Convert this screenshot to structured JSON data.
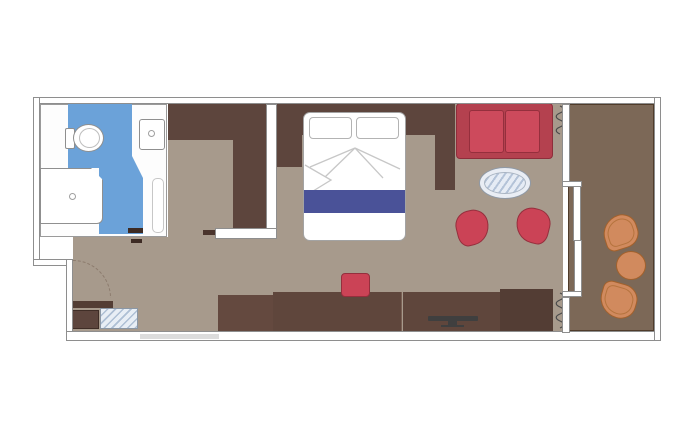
{
  "meta": {
    "type": "floor-plan",
    "subject": "cruise-ship-balcony-stateroom",
    "visible_text": "none"
  },
  "palette": {
    "wall_fill": "#ffffff",
    "wall_stroke": "#8e8e8e",
    "cabin_floor": "#a79a8c",
    "bathroom_floor": "#6ba2d9",
    "balcony_floor": "#7c6857",
    "dark_wood": "#5d453d",
    "desk_wood": "#5f463c",
    "red_upholstery": "#cb4356",
    "bed_runner_blue": "#4a5298",
    "glass_blue": "#e8eef5",
    "balcony_furniture_orange": "#d18a5e",
    "tv_gray": "#3f3f3f"
  },
  "rooms": [
    {
      "name": "bathroom",
      "floor_color": "#6ba2d9",
      "items": [
        "toilet",
        "shower",
        "washbasin",
        "sliding-door"
      ]
    },
    {
      "name": "entry-hall",
      "floor_color": "#a79a8c",
      "items": [
        "entrance-door-swing",
        "shelf",
        "cabinet",
        "glass-top-unit",
        "wardrobe"
      ]
    },
    {
      "name": "bedroom-living",
      "floor_color": "#a79a8c",
      "items": [
        "double-bed",
        "pillow",
        "pillow",
        "bed-runner",
        "nightstand",
        "nightstand",
        "sofa",
        "oval-glass-table",
        "armchair",
        "armchair",
        "desk",
        "stool",
        "tv",
        "curtains"
      ]
    },
    {
      "name": "balcony",
      "floor_color": "#7c6857",
      "items": [
        "deck-chair",
        "round-table",
        "deck-chair",
        "sliding-glass-door"
      ]
    }
  ],
  "counts": {
    "beds": 1,
    "sofas": 1,
    "red_armchairs": 2,
    "balcony_chairs": 2,
    "tables": 3
  }
}
